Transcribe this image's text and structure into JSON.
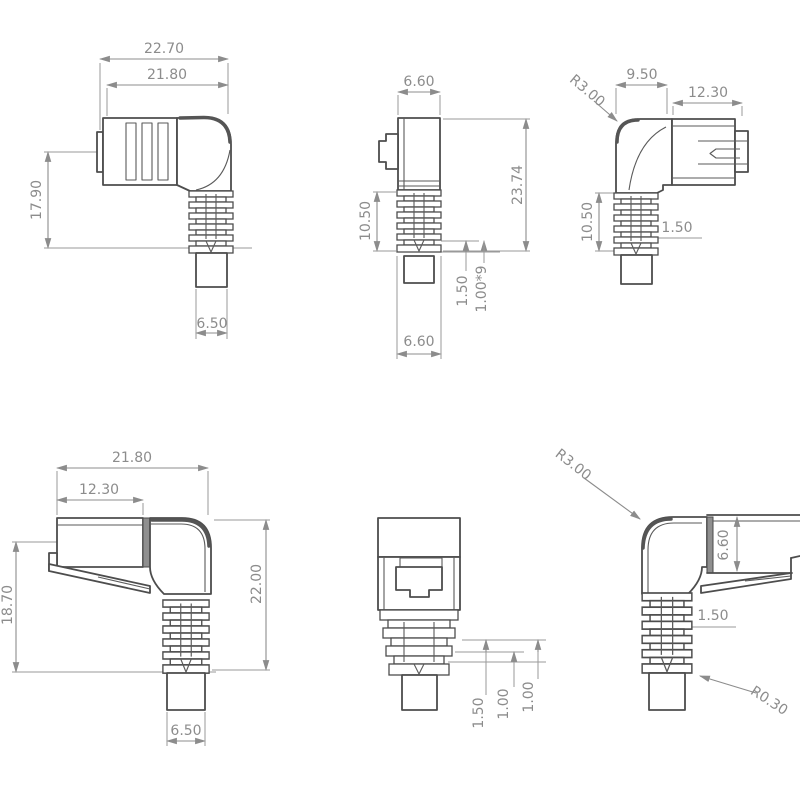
{
  "views": {
    "top_left": {
      "overall_width": "22.70",
      "body_width": "21.80",
      "height": "17.90",
      "cable_width": "6.50"
    },
    "top_mid": {
      "top_width": "6.60",
      "overall_height": "23.74",
      "relief_height": "10.50",
      "rib_space": "1.50",
      "rib_pitch": "1.00*9",
      "bottom_width": "6.60"
    },
    "top_right": {
      "bend_radius": "R3.00",
      "boot_width": "9.50",
      "plug_length": "12.30",
      "relief_height": "10.50",
      "rib_width": "1.50"
    },
    "bottom_left": {
      "body_width": "21.80",
      "plug_length": "12.30",
      "height": "18.70",
      "overall_height": "22.00",
      "cable_width": "6.50"
    },
    "bottom_mid": {
      "rib_space": "1.50",
      "rib_a": "1.00",
      "rib_b": "1.00"
    },
    "bottom_right": {
      "bend_radius": "R3.00",
      "plug_height": "6.60",
      "rib_width": "1.50",
      "rib_radius": "R0.30"
    }
  }
}
